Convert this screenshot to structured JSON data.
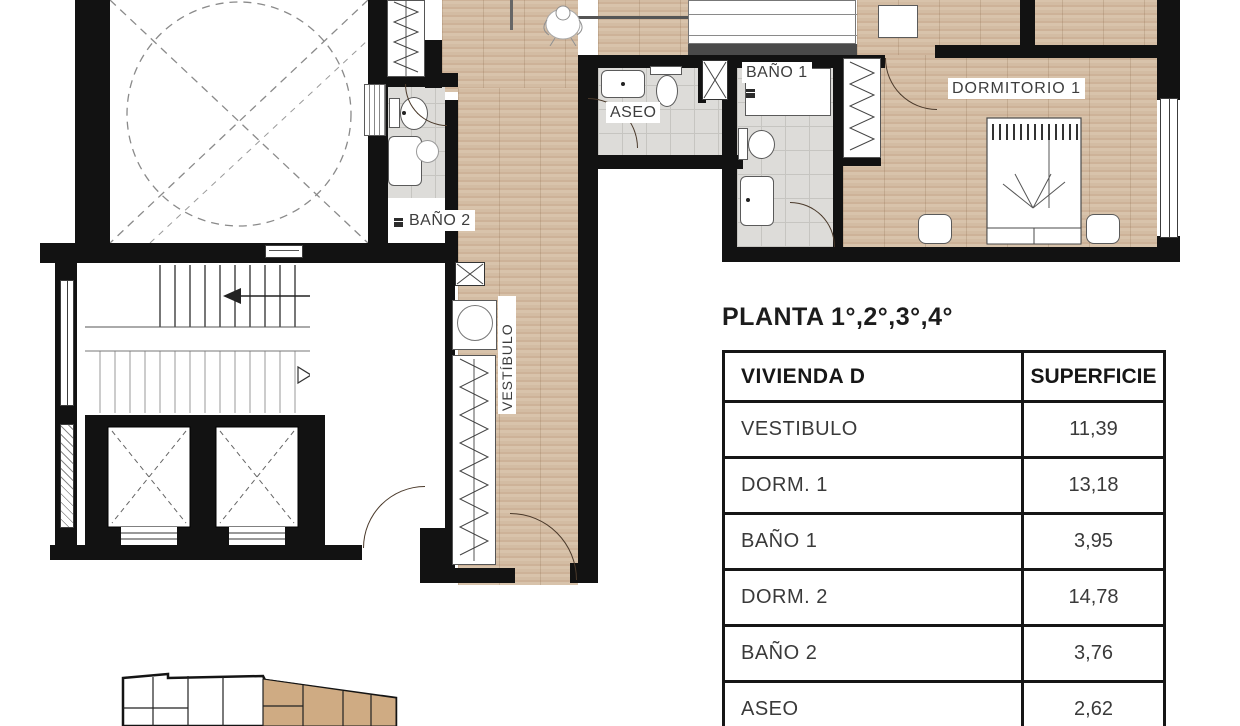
{
  "plan": {
    "labels": {
      "bano2": "BAÑO 2",
      "aseo": "ASEO",
      "bano1": "BAÑO 1",
      "dormitorio1": "DORMITORIO 1",
      "vestibulo": "VESTÍBULO"
    }
  },
  "section": {
    "title": "PLANTA 1°,2°,3°,4°"
  },
  "table": {
    "headers": {
      "unit": "VIVIENDA D",
      "area": "SUPERFICIE"
    },
    "rows": [
      {
        "label": "VESTIBULO",
        "value": "11,39"
      },
      {
        "label": "DORM. 1",
        "value": "13,18"
      },
      {
        "label": "BAÑO 1",
        "value": "3,95"
      },
      {
        "label": "DORM. 2",
        "value": "14,78"
      },
      {
        "label": "BAÑO 2",
        "value": "3,76"
      },
      {
        "label": "ASEO",
        "value": "2,62"
      }
    ]
  },
  "colors": {
    "wall": "#121212",
    "wood_floor": "#d1b99f",
    "tile_floor": "#dddcd9",
    "unit_highlight": "#cfab83",
    "text": "#3a3a3a"
  }
}
